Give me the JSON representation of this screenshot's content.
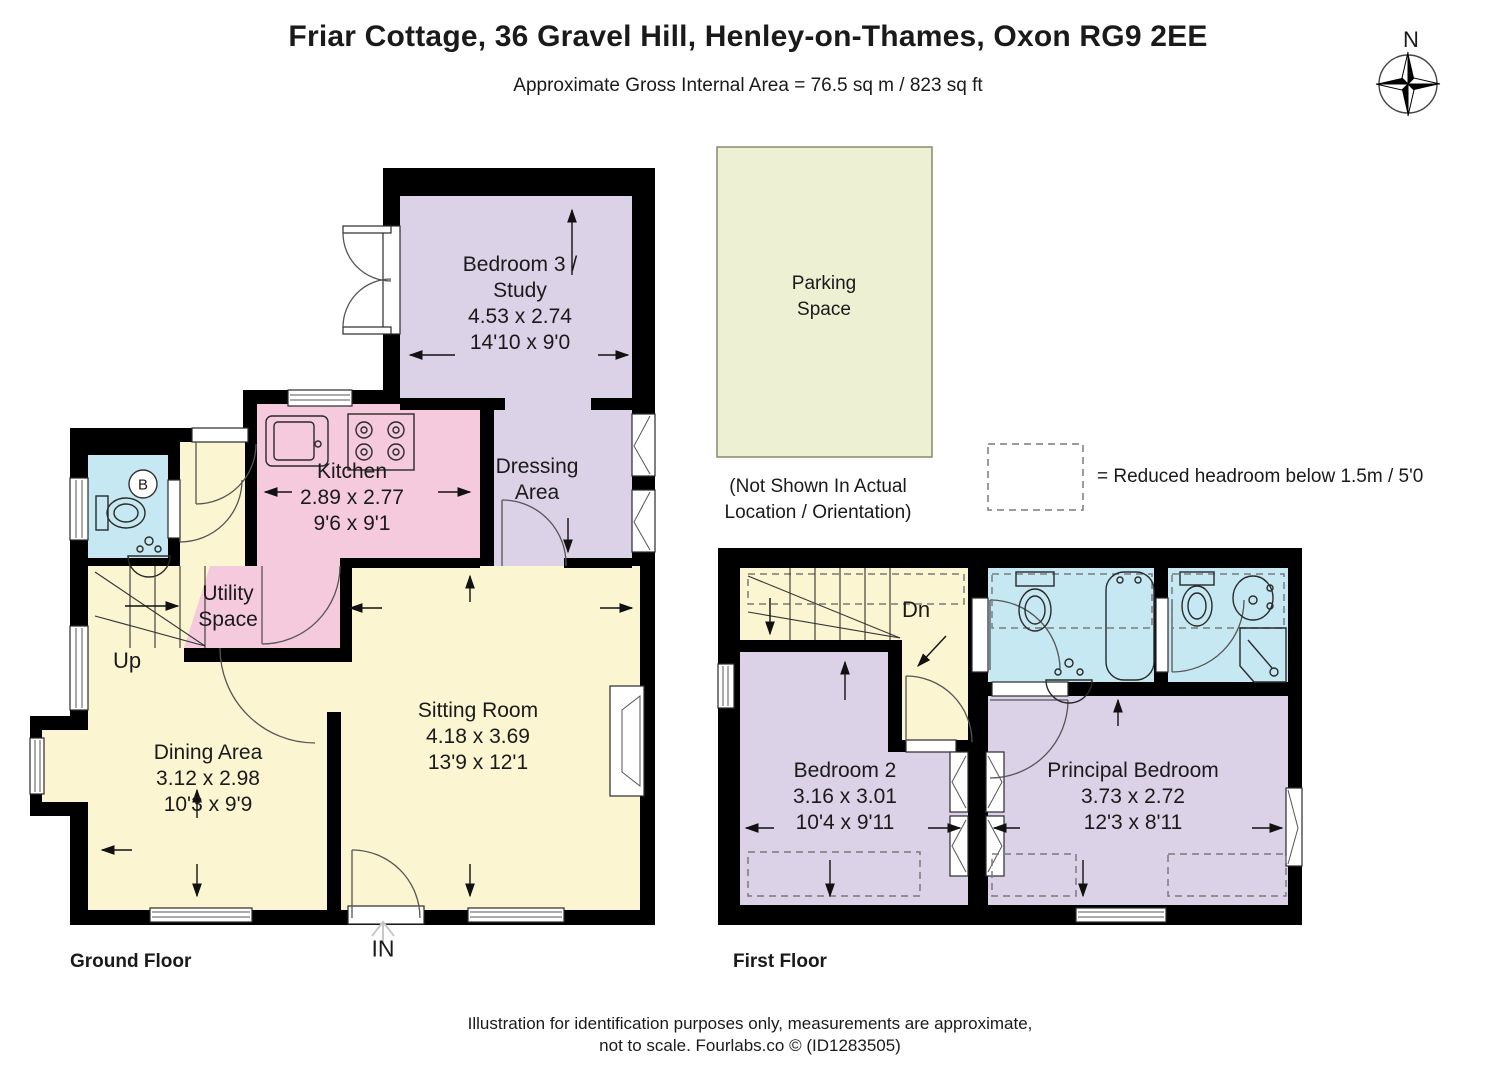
{
  "header": {
    "title": "Friar Cottage, 36 Gravel Hill, Henley-on-Thames, Oxon RG9 2EE",
    "subtitle": "Approximate Gross Internal Area = 76.5 sq m / 823 sq ft"
  },
  "compass": {
    "north_label": "N"
  },
  "parking": {
    "name_line1": "Parking",
    "name_line2": "Space",
    "note_line1": "(Not Shown In Actual",
    "note_line2": "Location / Orientation)"
  },
  "legend": {
    "reduced_headroom": "= Reduced headroom below 1.5m / 5'0"
  },
  "ground_floor": {
    "floor_label": "Ground Floor",
    "entrance_label": "IN",
    "stairs_label": "Up",
    "boiler_label": "B",
    "rooms": {
      "bedroom3": {
        "name1": "Bedroom 3 /",
        "name2": "Study",
        "metric": "4.53 x 2.74",
        "imperial": "14'10 x 9'0"
      },
      "dressing": {
        "name1": "Dressing",
        "name2": "Area"
      },
      "kitchen": {
        "name": "Kitchen",
        "metric": "2.89 x 2.77",
        "imperial": "9'6 x 9'1"
      },
      "utility": {
        "name1": "Utility",
        "name2": "Space"
      },
      "dining": {
        "name": "Dining Area",
        "metric": "3.12 x 2.98",
        "imperial": "10'3 x 9'9"
      },
      "sitting": {
        "name": "Sitting Room",
        "metric": "4.18 x 3.69",
        "imperial": "13'9 x 12'1"
      }
    }
  },
  "first_floor": {
    "floor_label": "First Floor",
    "stairs_label": "Dn",
    "rooms": {
      "bedroom2": {
        "name": "Bedroom 2",
        "metric": "3.16 x 3.01",
        "imperial": "10'4 x 9'11"
      },
      "principal": {
        "name": "Principal Bedroom",
        "metric": "3.73 x 2.72",
        "imperial": "12'3 x 8'11"
      }
    }
  },
  "footer": {
    "line1": "Illustration for identification purposes only, measurements are approximate,",
    "line2": "not to scale. Fourlabs.co © (ID1283505)"
  },
  "colors": {
    "wall": "#000000",
    "cream": "#fbf5d2",
    "pink": "#f5cadc",
    "purple": "#dcd2e7",
    "blue": "#c6e8f2",
    "parking": "#edf0d3"
  }
}
